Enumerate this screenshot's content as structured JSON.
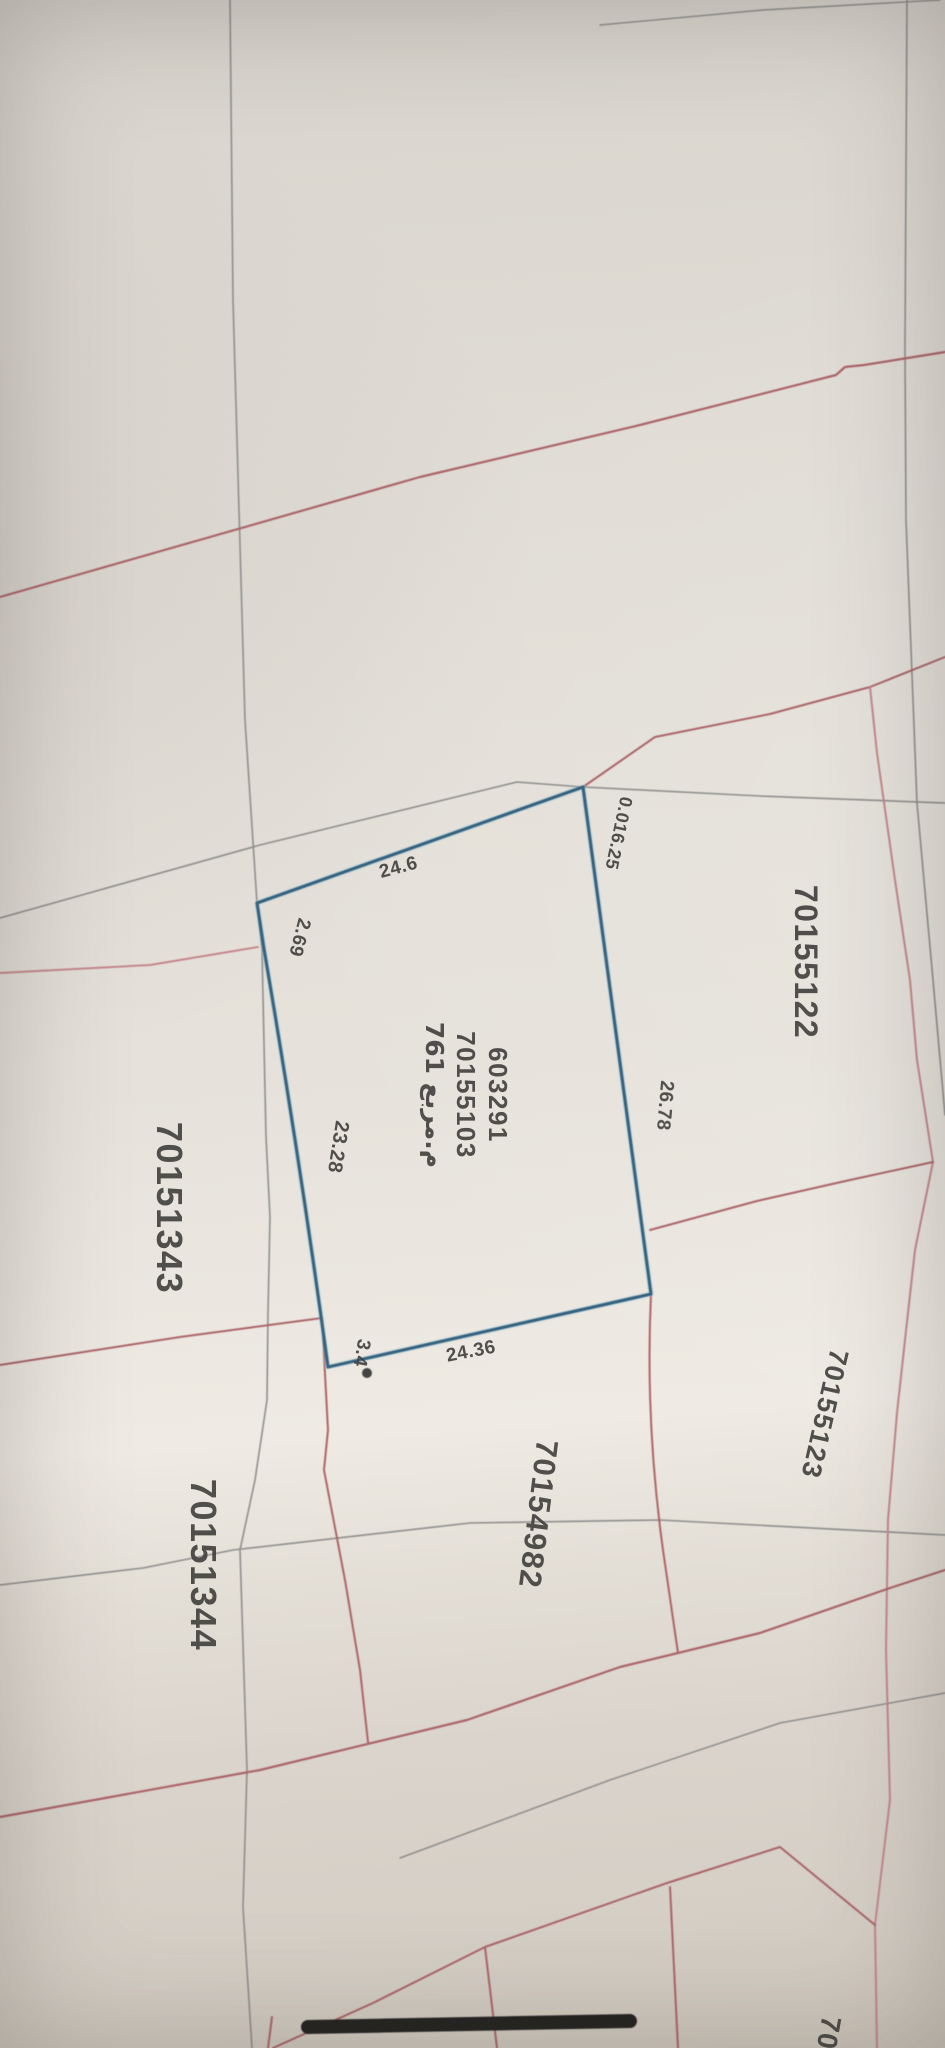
{
  "colors": {
    "paper": "#e4e0d9",
    "parcel_blue": "#2d5d7c",
    "parcel_glow": "#a9cddb",
    "boundary_red": "#a95f63",
    "boundary_red_light": "#c2848a",
    "grid_gray": "#8b8b89",
    "text_dark": "#3f3e3c",
    "black_bar": "#1d1d1b"
  },
  "highlighted_parcel": {
    "plot_number": "603291",
    "parcel_id": "70155103",
    "area_label": "761 م.مربع",
    "dimensions": {
      "north_corner": "0.016.25",
      "northwest_edge": "24.6",
      "west_edge_short": "2.69",
      "southwest_edge": "23.28",
      "south_corner": "3.4",
      "south_edge": "24.36",
      "east_edge": "26.78"
    }
  },
  "neighbor_parcels": {
    "east": "70155122",
    "west": "70151343",
    "south": "70154982",
    "southwest": "70151344",
    "southeast": "70155123",
    "bottom_partial": "701"
  }
}
